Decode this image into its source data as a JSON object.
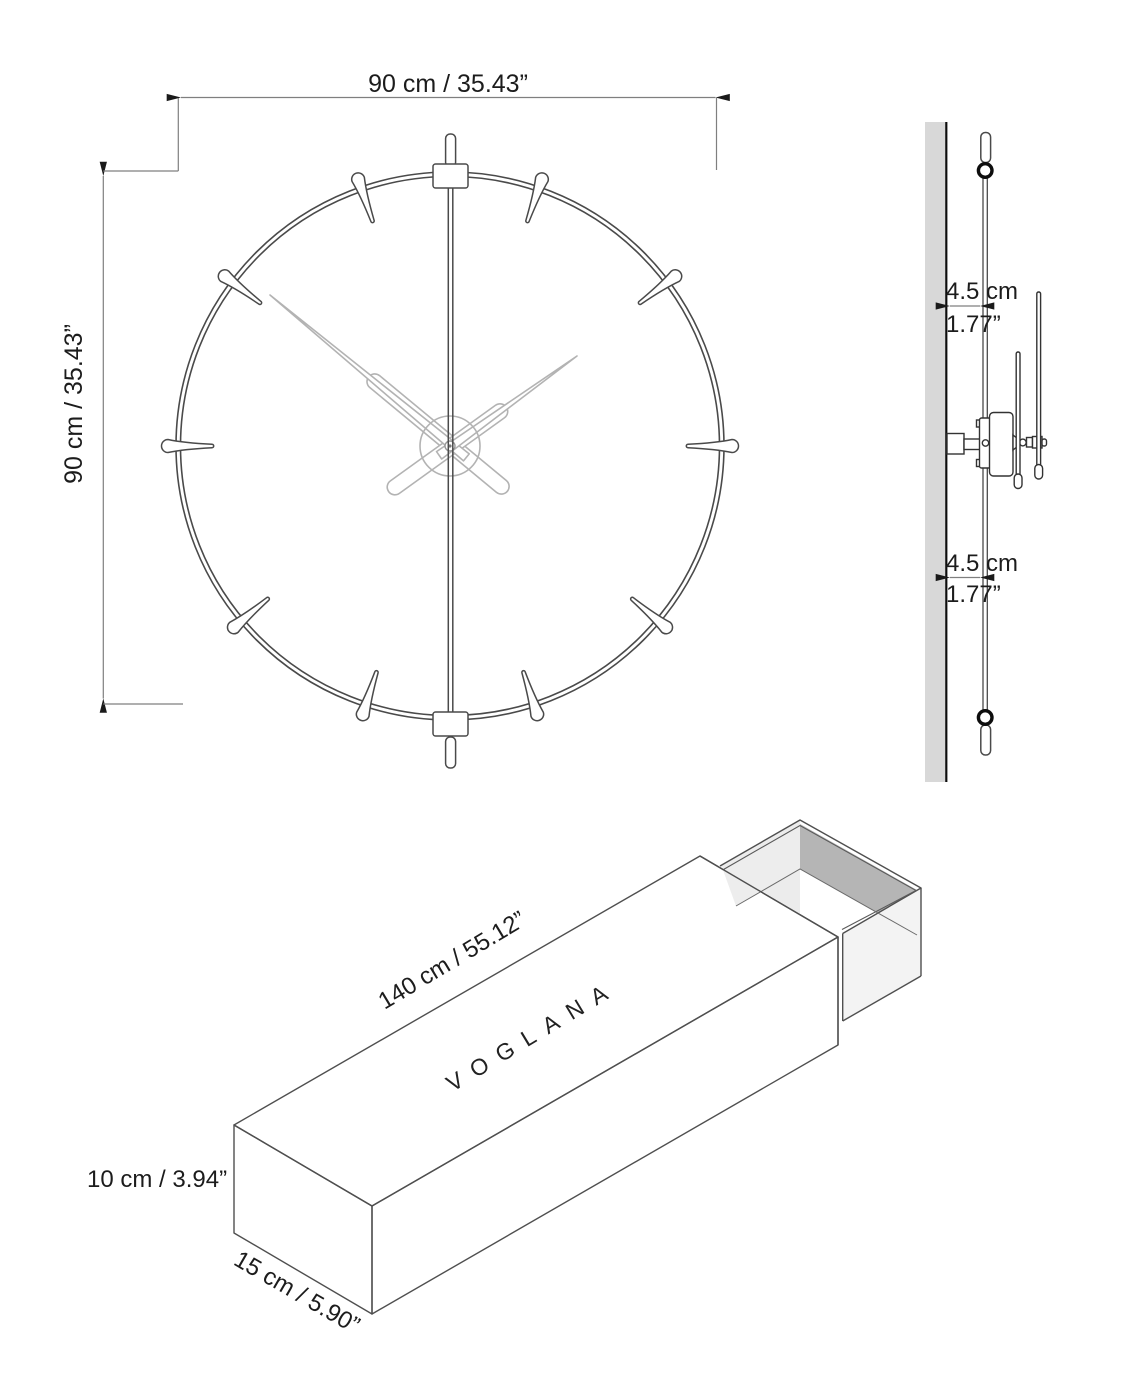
{
  "drawing": {
    "product": "wall clock technical drawing",
    "front_view": {
      "width_label": "90 cm / 35.43”",
      "height_label": "90 cm / 35.43”"
    },
    "side_view": {
      "top_offset_cm": "4.5 cm",
      "top_offset_inch": "1.77”",
      "bottom_offset_cm": "4.5 cm",
      "bottom_offset_inch": "1.77”"
    },
    "box_view": {
      "length_label": "140 cm / 55.12”",
      "brand": "VOGLANA",
      "height_label": "10 cm / 3.94”",
      "depth_label": "15 cm / 5.90”"
    },
    "colors": {
      "background": "#ffffff",
      "line_dark": "#4a4a4a",
      "hands_gray": "#b3b3b3",
      "wall_gray": "#d8d8d8",
      "box_side_gray": "#c8c8c8",
      "tray_inner_dark": "#b5b5b5",
      "tray_inner_light": "#ececec",
      "text": "#1c1c1c"
    }
  }
}
